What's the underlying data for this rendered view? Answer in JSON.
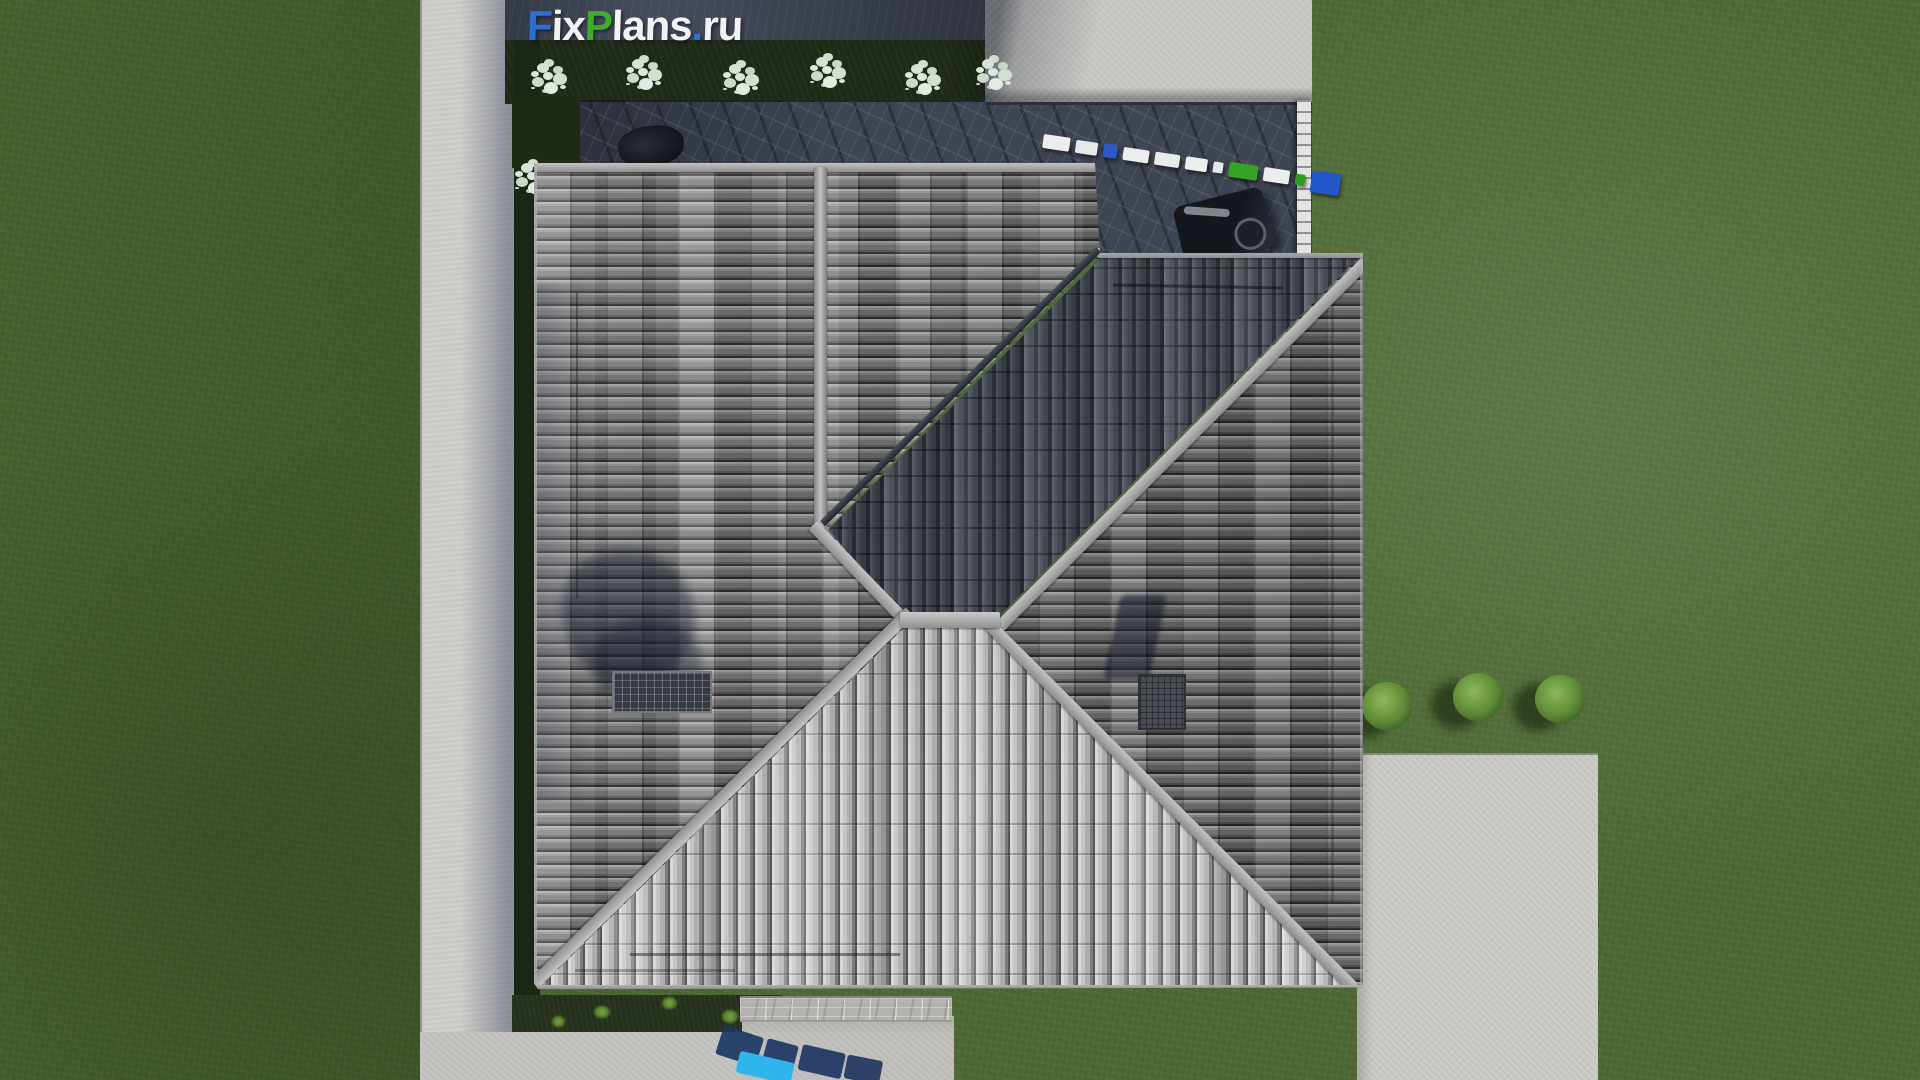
{
  "watermark": {
    "full_text": "FixPlans.ru",
    "parts": [
      {
        "text": "F",
        "style": "color:#2d6fd6"
      },
      {
        "text": "ix",
        "style": "color:#f2f2f2"
      },
      {
        "text": "P",
        "style": "color:#3fae27"
      },
      {
        "text": "lans",
        "style": "color:#f2f2f2"
      },
      {
        "text": ".",
        "style": "color:#2d6fd6"
      },
      {
        "text": "ru",
        "style": "color:#f2f2f2"
      }
    ]
  },
  "colors": {
    "brand_blue": "#2d6fd6",
    "brand_green": "#3fae27",
    "brand_white": "#f2f2f2",
    "accent_cyan": "#2fb4ec",
    "grass": "#4e6a34",
    "terrace_slate": "#3d4452",
    "roof_light_slope": "#a8a8a8",
    "roof_dark_slope": "#383c44",
    "concrete": "#c7c7c3"
  },
  "terrace_blocks": [
    {
      "style": "width:30px;height:14px;background:#eceded"
    },
    {
      "style": "width:24px;height:13px;background:#e6e7e8"
    },
    {
      "style": "width:15px;height:14px;background:#2b59c4"
    },
    {
      "style": "width:28px;height:13px;background:#eceded"
    },
    {
      "style": "width:28px;height:13px;background:#e9eaea"
    },
    {
      "style": "width:24px;height:13px;background:#eceded"
    },
    {
      "style": "width:11px;height:11px;background:#e6e7e8"
    },
    {
      "style": "width:32px;height:15px;background:#36a225"
    },
    {
      "style": "width:28px;height:14px;background:#eceded"
    },
    {
      "style": "width:11px;height:11px;background:#2f9a21"
    },
    {
      "style": "width:32px;height:22px;background:#2457c9"
    }
  ],
  "bottom_blocks": [
    {
      "style": "left:6px;top:8px;width:42px;height:30px;background:rgba(28,55,100,.92);transform:rotate(14deg)"
    },
    {
      "style": "left:52px;top:16px;width:32px;height:26px;background:rgba(26,52,96,.9);transform:rotate(11deg)"
    },
    {
      "style": "left:88px;top:20px;width:44px;height:26px;background:rgba(26,52,96,.9);transform:rotate(9deg)"
    },
    {
      "style": "left:134px;top:26px;width:36px;height:24px;background:rgba(24,48,90,.88);transform:rotate(7deg)"
    },
    {
      "style": "left:26px;top:32px;width:56px;height:22px;background:#2fb4ec;transform:rotate(9deg)"
    }
  ],
  "scene": {
    "top_bush_count": 6,
    "right_bush_count": 3
  }
}
